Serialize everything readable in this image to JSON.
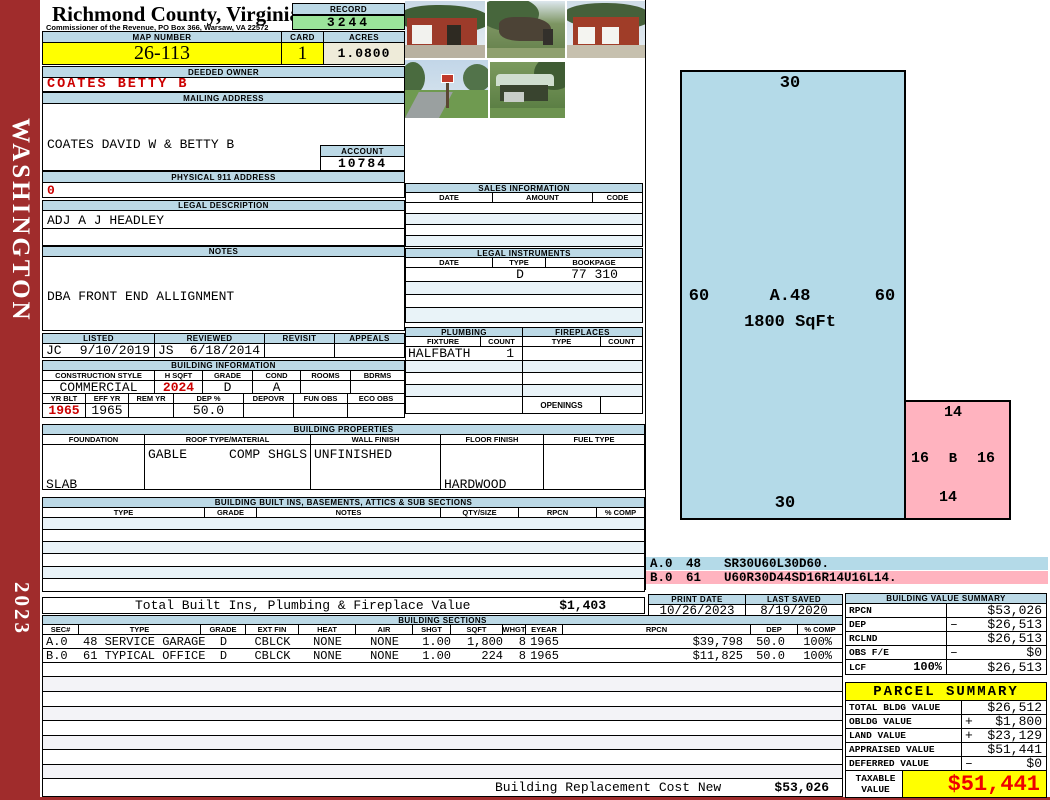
{
  "county": {
    "title": "Richmond County, Virginia",
    "subtitle": "Commissioner of the Revenue, PO Box 366, Warsaw, VA 22572"
  },
  "sidebar": {
    "district": "WASHINGTON",
    "year": "2023"
  },
  "record": {
    "label": "RECORD",
    "value": "3244"
  },
  "map": {
    "label": "MAP NUMBER",
    "value": "26-113"
  },
  "card": {
    "label": "CARD",
    "value": "1"
  },
  "acres": {
    "label": "ACRES",
    "value": "1.0800"
  },
  "owner": {
    "label": "DEEDED OWNER",
    "value": "COATES BETTY B"
  },
  "mailing": {
    "label": "MAILING ADDRESS",
    "lines": [
      "COATES DAVID W & BETTY B",
      "11072 RICHMOND ROAD",
      "WARSAW, VA 22572-0000"
    ]
  },
  "account": {
    "label": "ACCOUNT",
    "value": "10784"
  },
  "physical": {
    "label": "PHYSICAL 911 ADDRESS",
    "value": "0"
  },
  "legal_desc": {
    "label": "LEGAL DESCRIPTION",
    "value": "ADJ A J HEADLEY"
  },
  "notes": {
    "label": "NOTES",
    "lines": [
      "DBA FRONT END ALLIGNMENT",
      "PER HEARING 1/4/11: NO CHANGE",
      "08/2020-TP REQ MAIL TO ADDR CHANGE"
    ]
  },
  "visits": {
    "headers": [
      "LISTED",
      "REVIEWED",
      "REVISIT",
      "APPEALS"
    ],
    "listed_by": "JC",
    "listed_date": "9/10/2019",
    "reviewed_by": "JS",
    "reviewed_date": "6/18/2014",
    "revisit": "",
    "appeals": ""
  },
  "building_info": {
    "title": "BUILDING INFORMATION",
    "row1_headers": [
      "CONSTRUCTION STYLE",
      "H SQFT",
      "GRADE",
      "COND",
      "ROOMS",
      "BDRMS"
    ],
    "style": "COMMERCIAL",
    "hsqft": "2024",
    "grade": "D",
    "cond": "A",
    "rooms": "",
    "bdrms": "",
    "row2_headers": [
      "YR BLT",
      "EFF YR",
      "REM YR",
      "DEP %",
      "DEPOVR",
      "FUN OBS",
      "ECO OBS"
    ],
    "yr_blt": "1965",
    "eff_yr": "1965",
    "rem_yr": "",
    "dep_pct": "50.0",
    "depovr": "",
    "fun_obs": "",
    "eco_obs": ""
  },
  "building_props": {
    "title": "BUILDING PROPERTIES",
    "headers": [
      "FOUNDATION",
      "ROOF TYPE/MATERIAL",
      "WALL FINISH",
      "FLOOR FINISH",
      "FUEL TYPE"
    ],
    "foundation_lines": [
      "SLAB",
      "CONCRETE"
    ],
    "roof_type": "GABLE",
    "roof_material": "COMP SHGLS",
    "wall_finish": "UNFINISHED",
    "floor_lines": [
      "HARDWOOD",
      "VINYL"
    ],
    "fuel": ""
  },
  "built_ins": {
    "title": "BUILDING BUILT INS, BASEMENTS, ATTICS & SUB SECTIONS",
    "headers": [
      "TYPE",
      "GRADE",
      "NOTES",
      "QTY/SIZE",
      "RPCN",
      "% COMP"
    ]
  },
  "sales": {
    "title": "SALES INFORMATION",
    "headers": [
      "DATE",
      "AMOUNT",
      "CODE"
    ]
  },
  "instruments": {
    "title": "LEGAL INSTRUMENTS",
    "headers": [
      "DATE",
      "TYPE",
      "BOOKPAGE"
    ],
    "row": {
      "date": "",
      "type": "D",
      "bookpage": "77 310"
    }
  },
  "plumbing": {
    "title": "PLUMBING",
    "headers": [
      "FIXTURE",
      "COUNT"
    ],
    "row": {
      "fixture": "HALFBATH",
      "count": "1"
    }
  },
  "fireplaces": {
    "title": "FIREPLACES",
    "headers": [
      "TYPE",
      "COUNT"
    ],
    "openings_label": "OPENINGS"
  },
  "sketch": {
    "a": {
      "top": "30",
      "left": "60",
      "label": "A.48",
      "right": "60",
      "sqft": "1800 SqFt",
      "bottom": "30"
    },
    "b": {
      "top": "14",
      "left": "16",
      "label": "B",
      "right": "16",
      "bottom": "14"
    },
    "legend": [
      {
        "sec": "A.0",
        "code": "48",
        "trace": "SR30U60L30D60."
      },
      {
        "sec": "B.0",
        "code": "61",
        "trace": "U60R30D44SD16R14U16L14."
      }
    ]
  },
  "totals": {
    "built_label": "Total Built Ins, Plumbing & Fireplace Value",
    "built_value": "$1,403",
    "replacement_label": "Building Replacement Cost New",
    "replacement_value": "$53,026"
  },
  "print_info": {
    "print_label": "PRINT DATE",
    "print_date": "10/26/2023",
    "saved_label": "LAST SAVED",
    "saved_date": "8/19/2020"
  },
  "bvs": {
    "title": "BUILDING VALUE SUMMARY",
    "rows": [
      {
        "label": "RPCN",
        "sign": "",
        "value": "$53,026"
      },
      {
        "label": "DEP",
        "sign": "–",
        "value": "$26,513"
      },
      {
        "label": "RCLND",
        "sign": "",
        "value": "$26,513"
      },
      {
        "label": "OBS F/E",
        "sign": "–",
        "value": "$0"
      },
      {
        "label": "LCF",
        "pct": "100%",
        "sign": "",
        "value": "$26,513"
      }
    ]
  },
  "parcel": {
    "title": "PARCEL SUMMARY",
    "rows": [
      {
        "label": "TOTAL BLDG VALUE",
        "sign": "",
        "value": "$26,512"
      },
      {
        "label": "OBLDG VALUE",
        "sign": "+",
        "value": "$1,800"
      },
      {
        "label": "LAND VALUE",
        "sign": "+",
        "value": "$23,129"
      },
      {
        "label": "APPRAISED VALUE",
        "sign": "",
        "value": "$51,441"
      },
      {
        "label": "DEFERRED VALUE",
        "sign": "–",
        "value": "$0"
      }
    ],
    "taxable_label": "TAXABLE VALUE",
    "taxable_value": "$51,441"
  },
  "sections": {
    "title": "BUILDING SECTIONS",
    "headers": [
      "SEC#",
      "TYPE",
      "GRADE",
      "EXT FIN",
      "HEAT",
      "AIR",
      "SHGT",
      "SQFT",
      "WHGT",
      "EYEAR",
      "RPCN",
      "DEP",
      "% COMP"
    ],
    "rows": [
      {
        "sec": "A.0",
        "type": "48 SERVICE GARAGE",
        "grade": "D",
        "ext_fin": "CBLCK",
        "heat": "NONE",
        "air": "NONE",
        "shgt": "1.00",
        "sqft": "1,800",
        "whgt": "8",
        "eyear": "1965",
        "rpcn": "$39,798",
        "dep": "50.0",
        "comp": "100%"
      },
      {
        "sec": "B.0",
        "type": "61 TYPICAL OFFICE",
        "grade": "D",
        "ext_fin": "CBLCK",
        "heat": "NONE",
        "air": "NONE",
        "shgt": "1.00",
        "sqft": "224",
        "whgt": "8",
        "eyear": "1965",
        "rpcn": "$11,825",
        "dep": "50.0",
        "comp": "100%"
      }
    ]
  },
  "colors": {
    "header_blue": "#BCD9E6",
    "record_green": "#9BE49B",
    "highlight_yellow": "#FFFF00",
    "acres_beige": "#EEEBD9",
    "sidebar_red": "#A02C2C",
    "value_red": "#CC0000",
    "sketch_blue": "#B4DAE8",
    "sketch_pink": "#FFB3BF",
    "taxable_red": "#EE0000"
  }
}
